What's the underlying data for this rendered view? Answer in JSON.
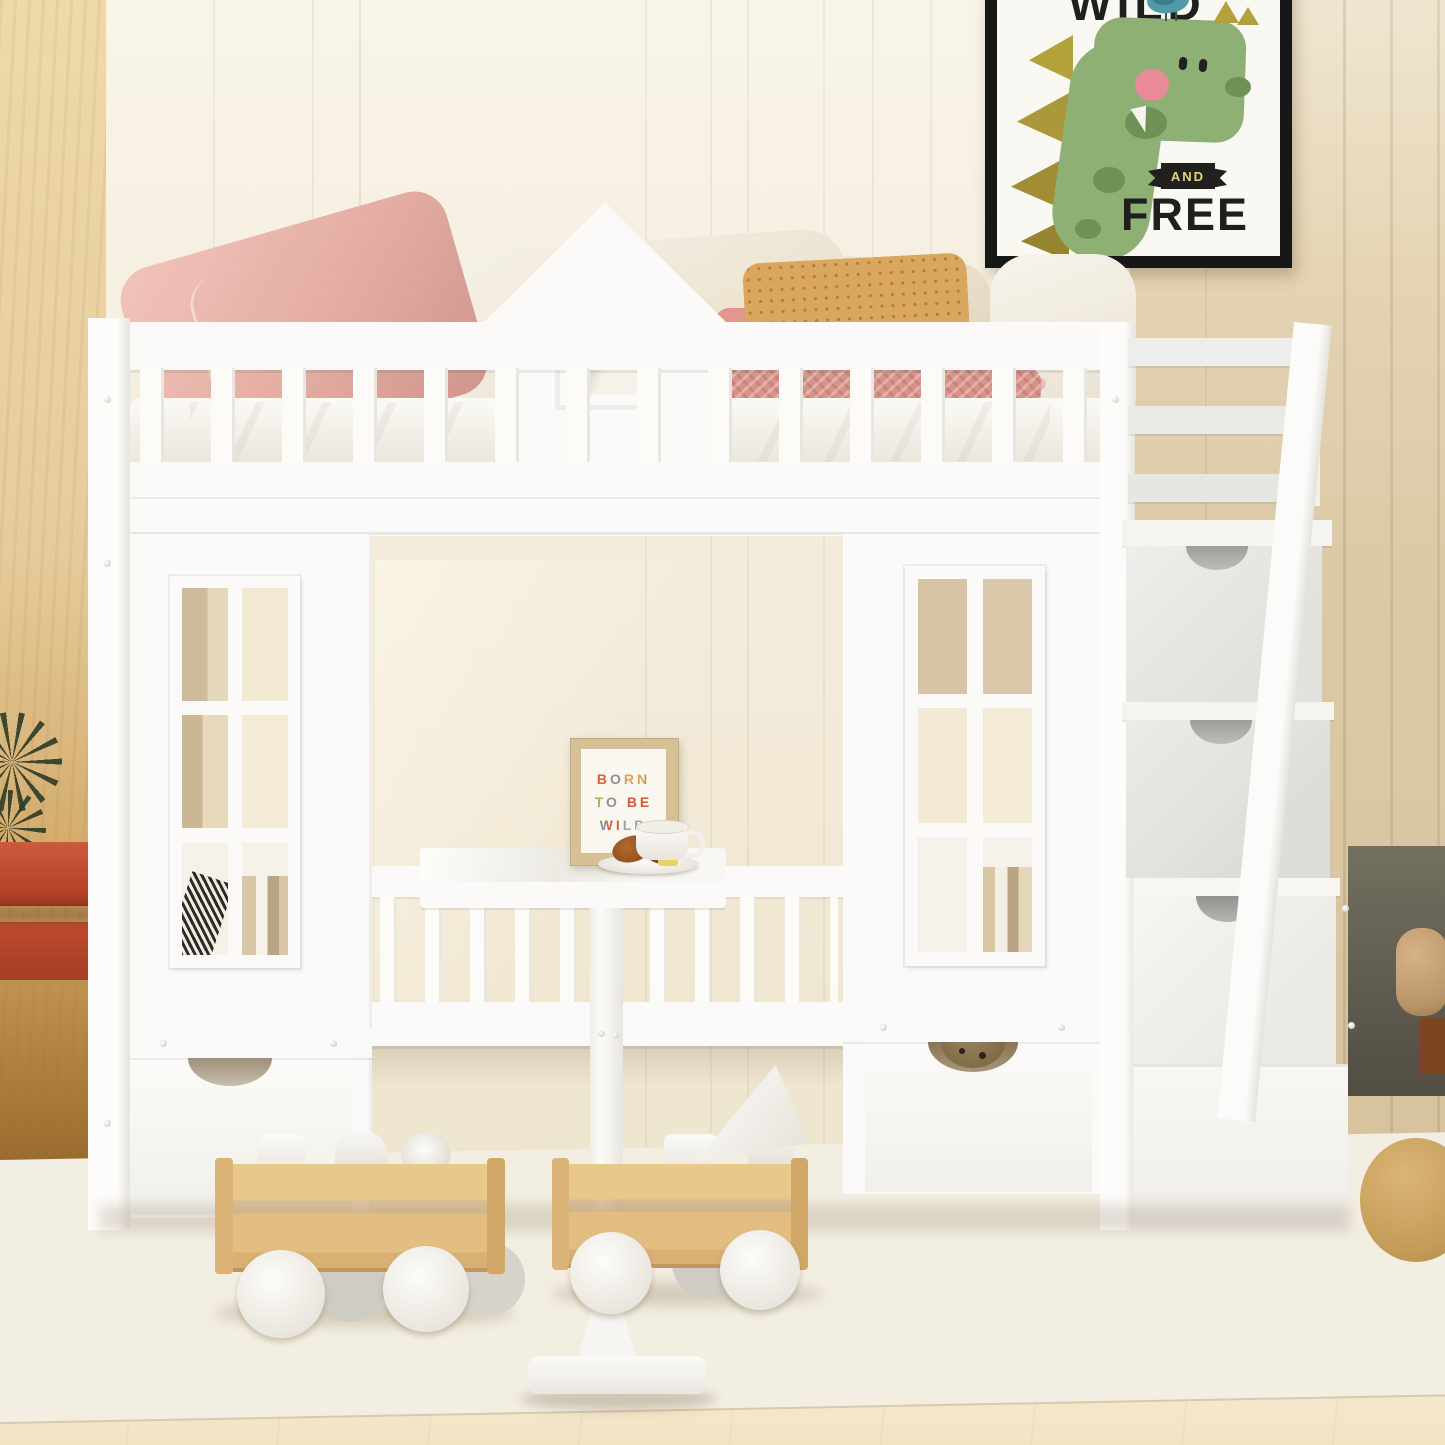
{
  "scene_title": "Kids loft bed with staircase storage in playroom",
  "poster": {
    "word_wild": "WILD",
    "word_and": "AND",
    "word_free": "FREE"
  },
  "framed_print": {
    "line1": "BORN",
    "line2": "TO BE",
    "line3": "WILD"
  },
  "palette": {
    "bed_white": "#fbfaf8",
    "wall_cream": "#f4eddd",
    "wall_tan": "#dcc9a6",
    "wood_panel": "#e8cf9e",
    "floor_wood": "#f0dfbd",
    "rug_cream": "#f3eee2",
    "rug_pink": "#f5d7d0",
    "rug_mint": "#c2e4d8",
    "rug_yellow": "#f1e1a0",
    "pillow_pink": "#e9b7ad",
    "pillow_mustard": "#d9a75f",
    "blanket_pink": "#d9948a",
    "dino_green": "#8fb074",
    "dino_spike": "#b3a23c",
    "bird_teal": "#4f9aa7",
    "stool_red": "#bb4a2e",
    "stair_grey": "#e7e6e3",
    "teddy_brown": "#8a7452"
  }
}
